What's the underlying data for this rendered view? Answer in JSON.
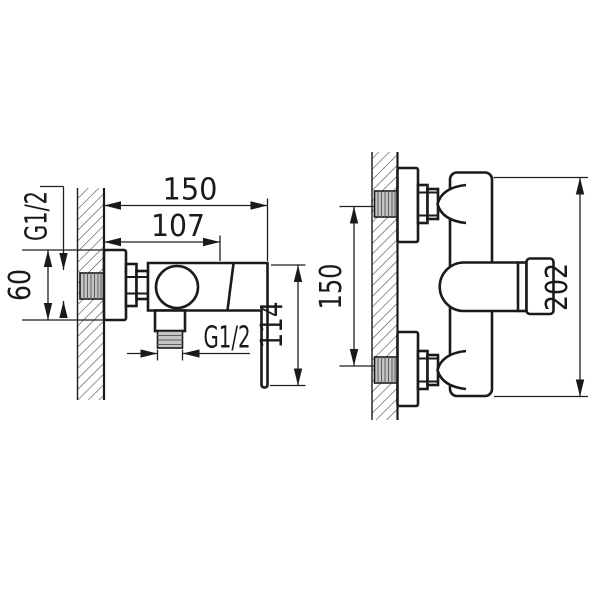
{
  "side_view": {
    "dim_total_width": "150",
    "dim_cartridge_offset": "107",
    "dim_wall_thread": "G1/2",
    "dim_escutcheon_height": "60",
    "dim_outlet_thread": "G1/2",
    "dim_handle_height": "114"
  },
  "front_view": {
    "dim_connection_spacing": "150",
    "dim_overall_height": "202"
  },
  "colors": {
    "line": "#1a1a1a",
    "background": "#ffffff",
    "thread_fill": "#c4c4c4"
  }
}
